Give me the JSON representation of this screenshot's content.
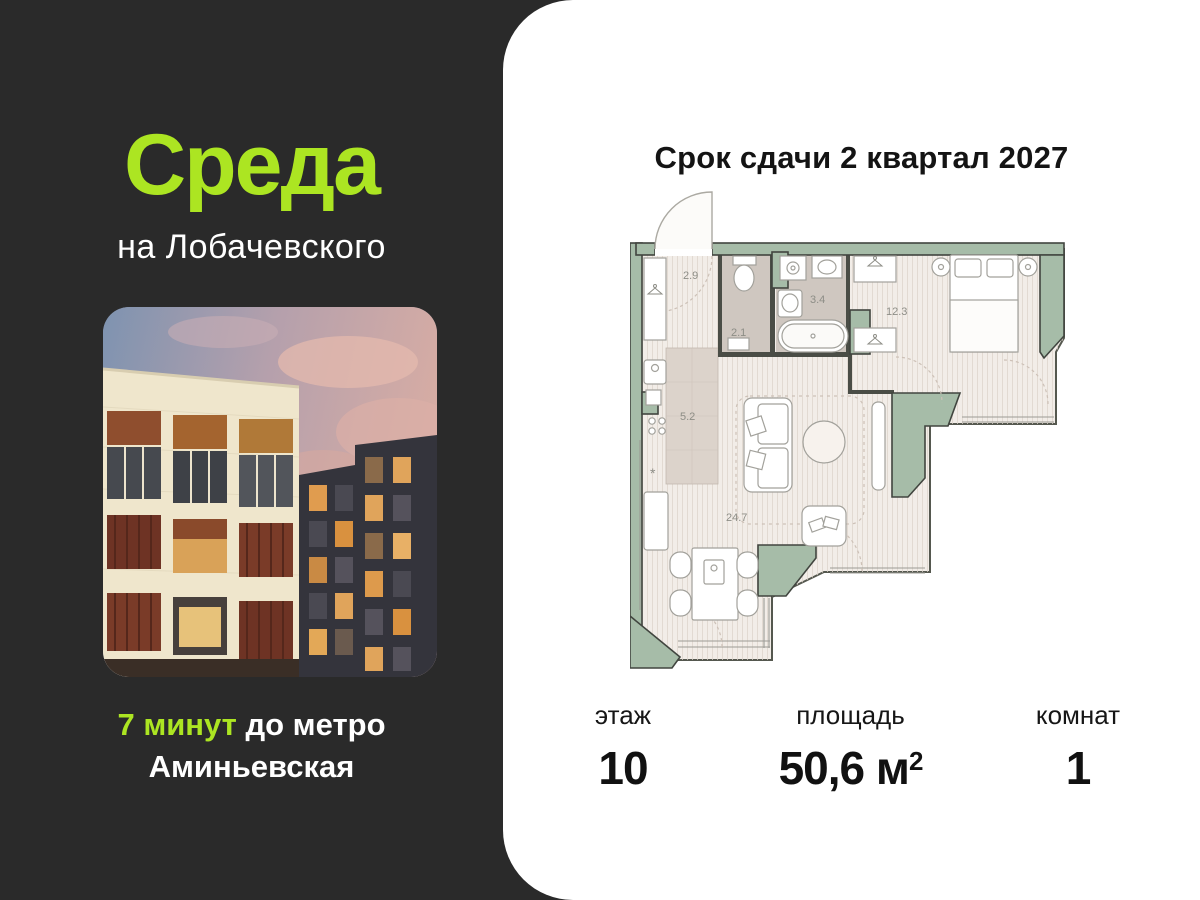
{
  "brand": {
    "logo": "Среда",
    "sublogo": "на Лобачевского",
    "accent_color": "#ACE522",
    "background_color": "#2A2A2A"
  },
  "metro": {
    "highlight": "7 минут",
    "rest": " до метро",
    "line2": "Аминьевская"
  },
  "panel": {
    "title": "Срок сдачи 2 квартал 2027"
  },
  "floorplan": {
    "areas": {
      "hallway": "2.9",
      "wc": "2.1",
      "bathroom": "3.4",
      "bedroom": "12.3",
      "kitchen": "5.2",
      "living": "24.7"
    },
    "freezer_star": "*",
    "wall_color": "#A6BCA8",
    "floor_color": "#F2EDE8",
    "wet_floor_color": "#CFC7C0"
  },
  "stats": {
    "floor": {
      "label": "этаж",
      "value": "10"
    },
    "area": {
      "label": "площадь",
      "value": "50,6 м",
      "sup": "2"
    },
    "rooms": {
      "label": "комнат",
      "value": "1"
    }
  }
}
